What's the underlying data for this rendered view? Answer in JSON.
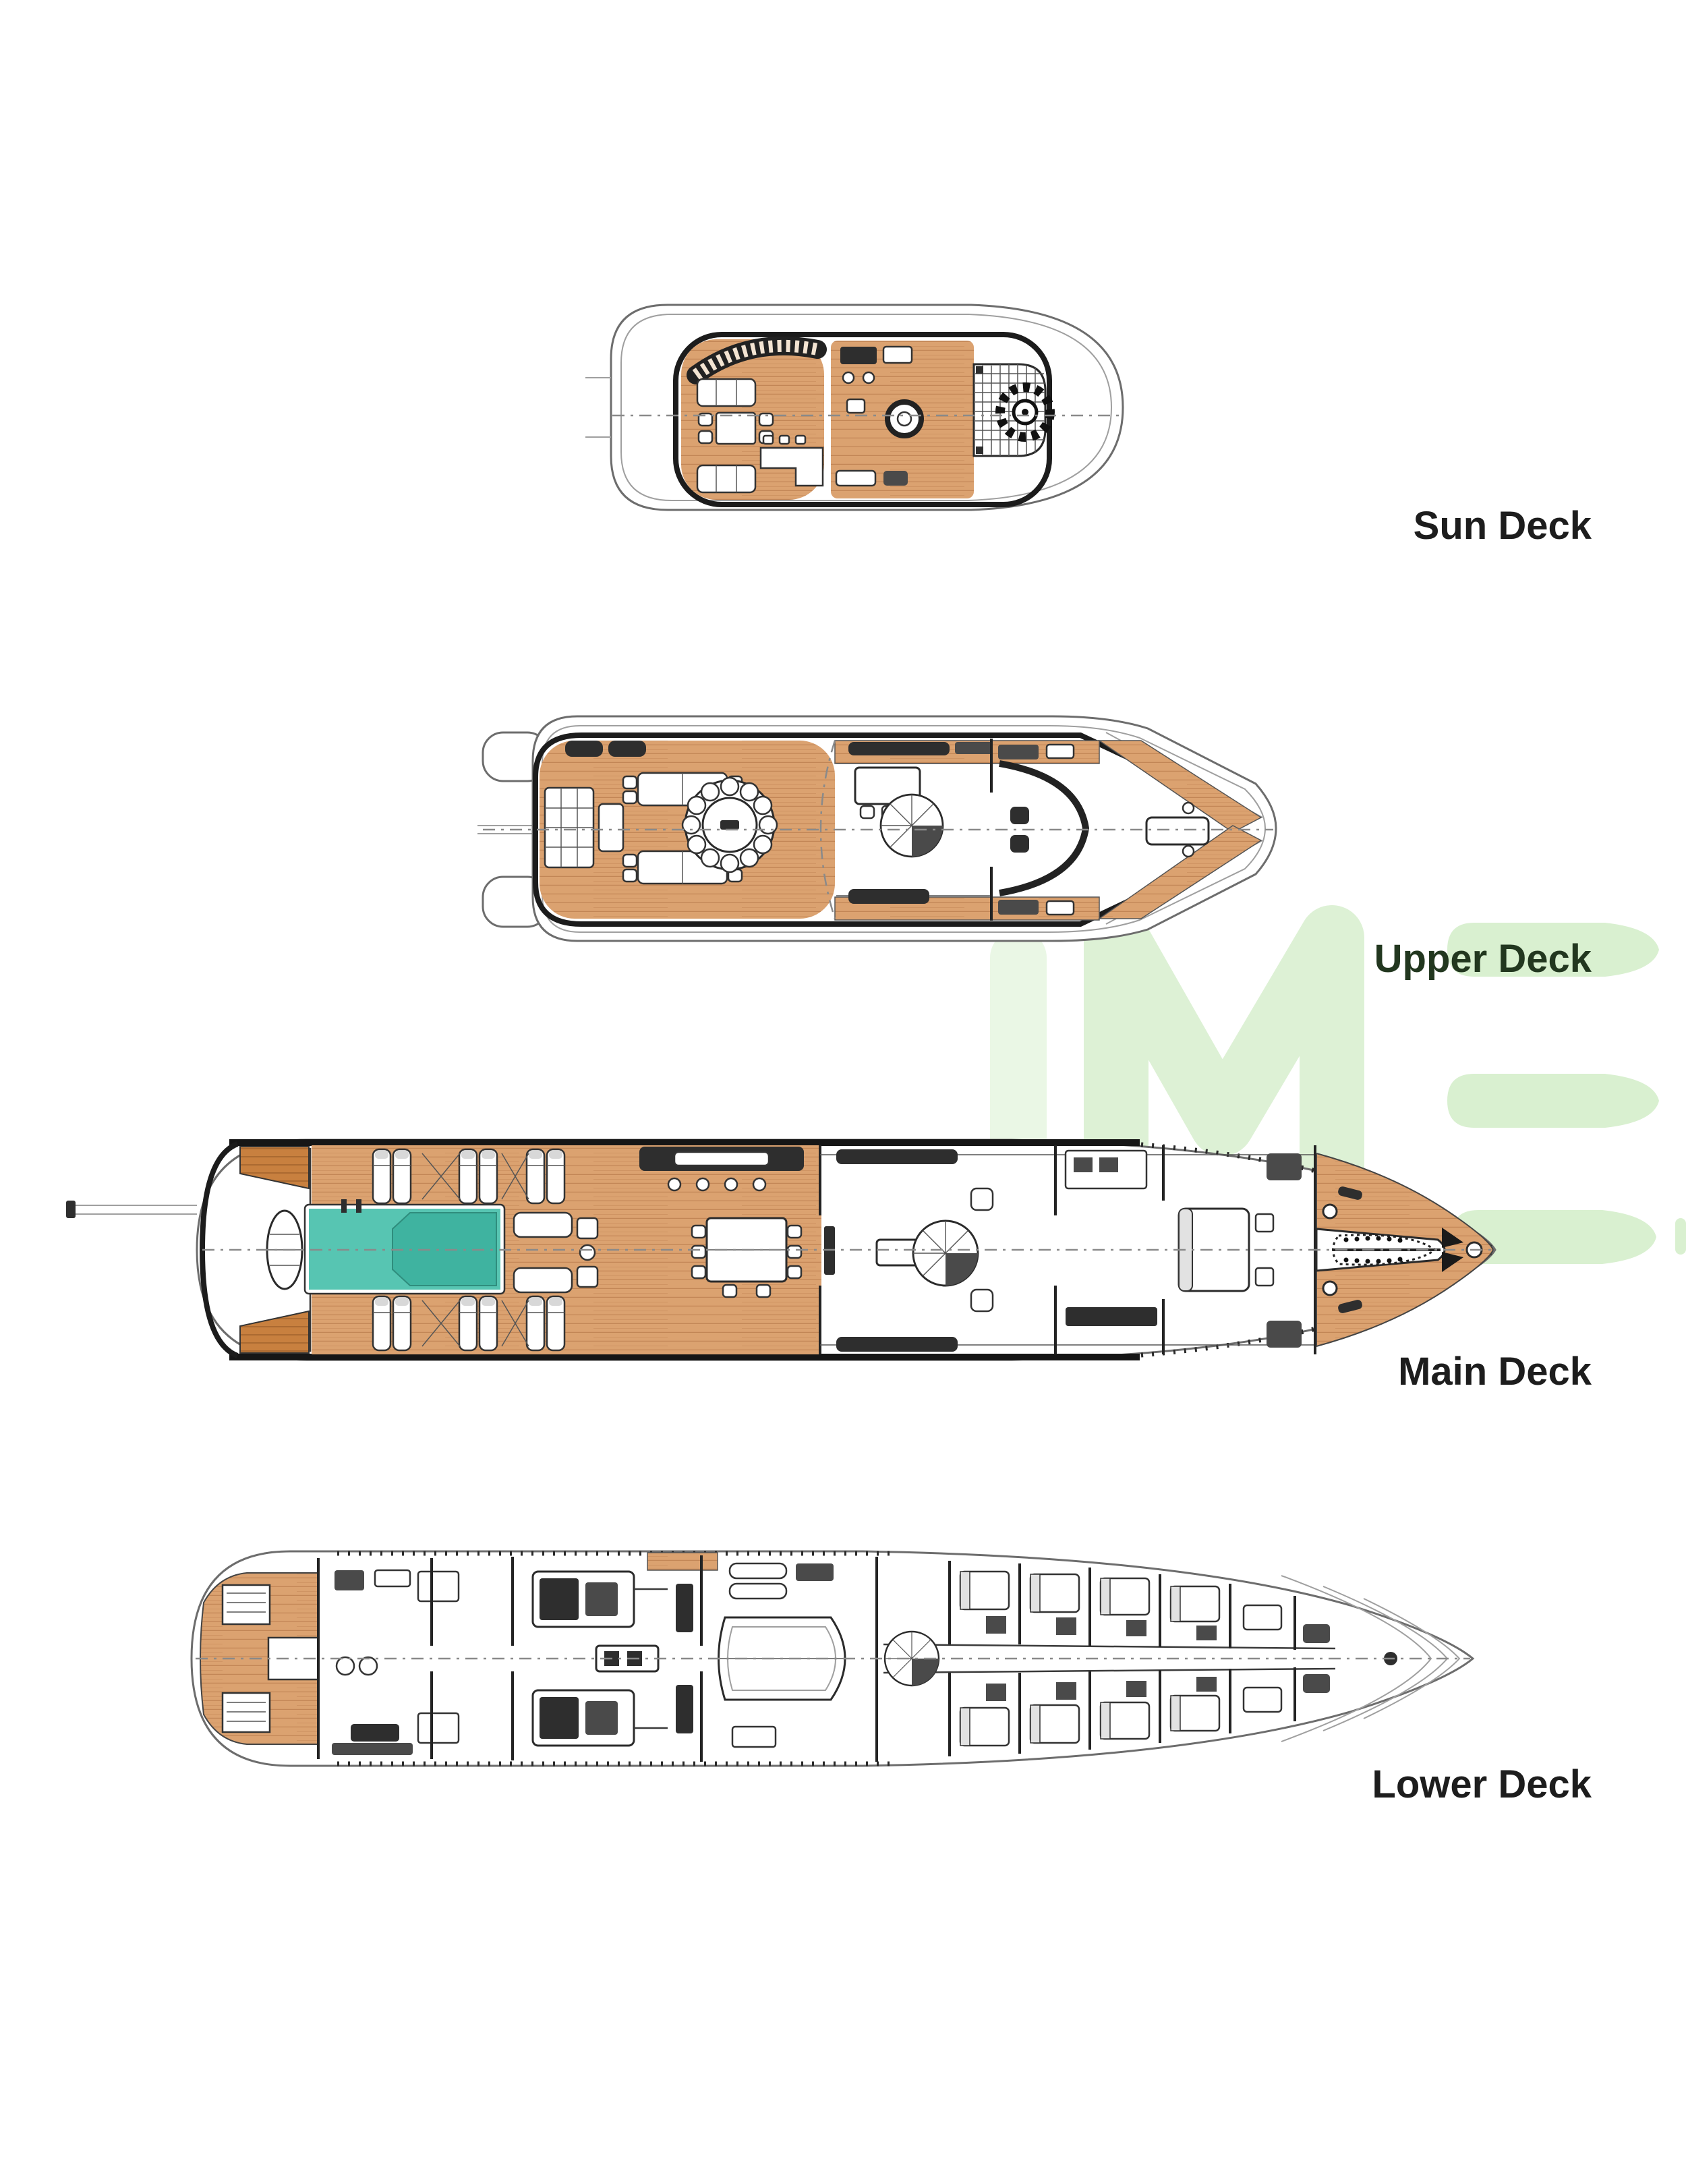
{
  "page": {
    "background": "#ffffff"
  },
  "decks": [
    {
      "id": "sun-deck",
      "label": "Sun Deck"
    },
    {
      "id": "upper-deck",
      "label": "Upper Deck"
    },
    {
      "id": "main-deck",
      "label": "Main Deck"
    },
    {
      "id": "lower-deck",
      "label": "Lower Deck"
    }
  ],
  "watermark": {
    "text": "IME",
    "color": "#d9f0d0"
  },
  "colors": {
    "teak": "#dba270",
    "teak_dark": "#c8803f",
    "pool": "#57c5b2",
    "pool_inner": "#3fb3a0",
    "outline": "#1c1c1c",
    "label": "#1d1d1d"
  }
}
